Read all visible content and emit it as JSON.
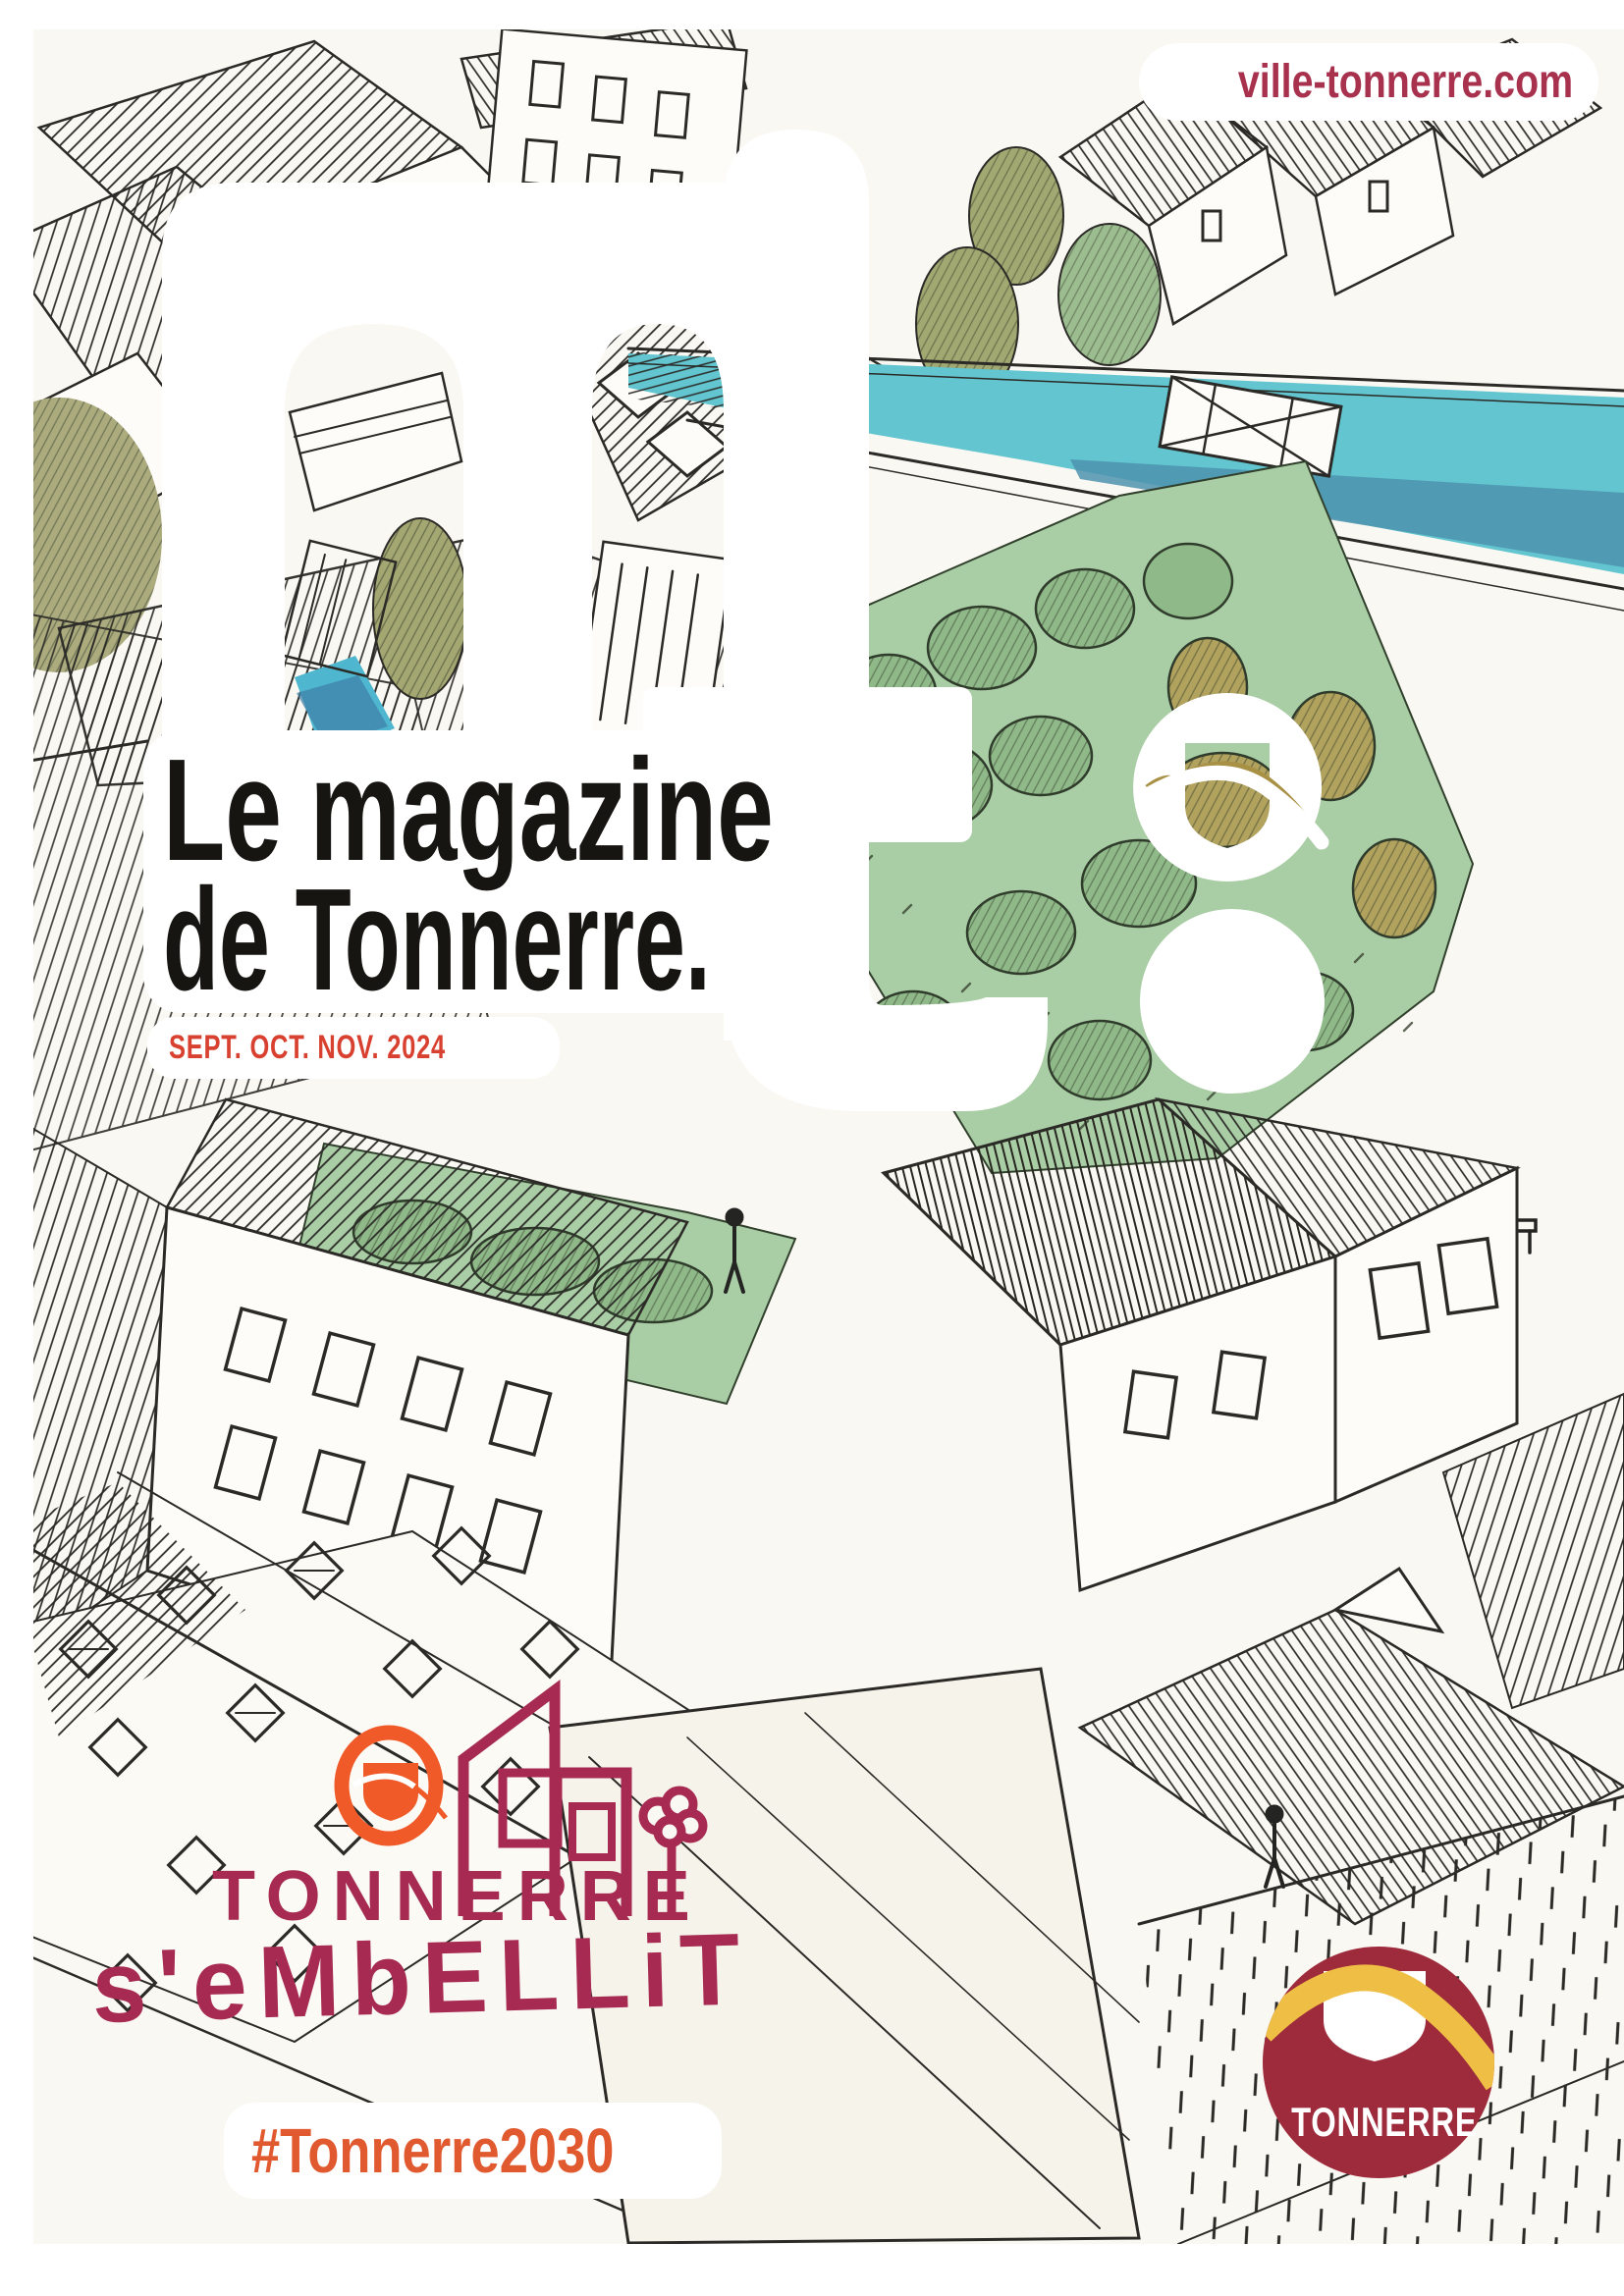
{
  "page": {
    "kind": "municipal magazine cover",
    "background_color": "#faf8f2",
    "ink_color": "#2b2a27"
  },
  "header": {
    "website_url": "ville-tonnerre.com",
    "url_color": "#a8314e"
  },
  "masthead": {
    "letter_m": "m",
    "letter_t": "t",
    "wordmark": "mt.",
    "letter_color": "#ffffff"
  },
  "title": {
    "line1": "Le magazine",
    "line2": "de Tonnerre.",
    "color": "#171512"
  },
  "issue": {
    "date": "SEPT. OCT. NOV. 2024",
    "color": "#d8402f"
  },
  "campaign": {
    "city": "TONNERRE",
    "tagline": "s'eMbELLiT",
    "hashtag": "#Tonnerre2030",
    "magenta": "#a62a52",
    "orange": "#e8572f"
  },
  "badge": {
    "city": "TONNERRE",
    "background": "#9e2b3c",
    "gold": "#efbf45",
    "shield": "#ffffff"
  },
  "illustration": {
    "description": "hand-drawn aerial pen sketch of the town of Tonnerre with watercolor washes",
    "canal_color": "#62c5cf",
    "canal_shadow_color": "#4e93ae",
    "park_color": "#a9cda4",
    "tree_green_color": "#8fb989",
    "tree_olive_color": "#a8a46d"
  }
}
